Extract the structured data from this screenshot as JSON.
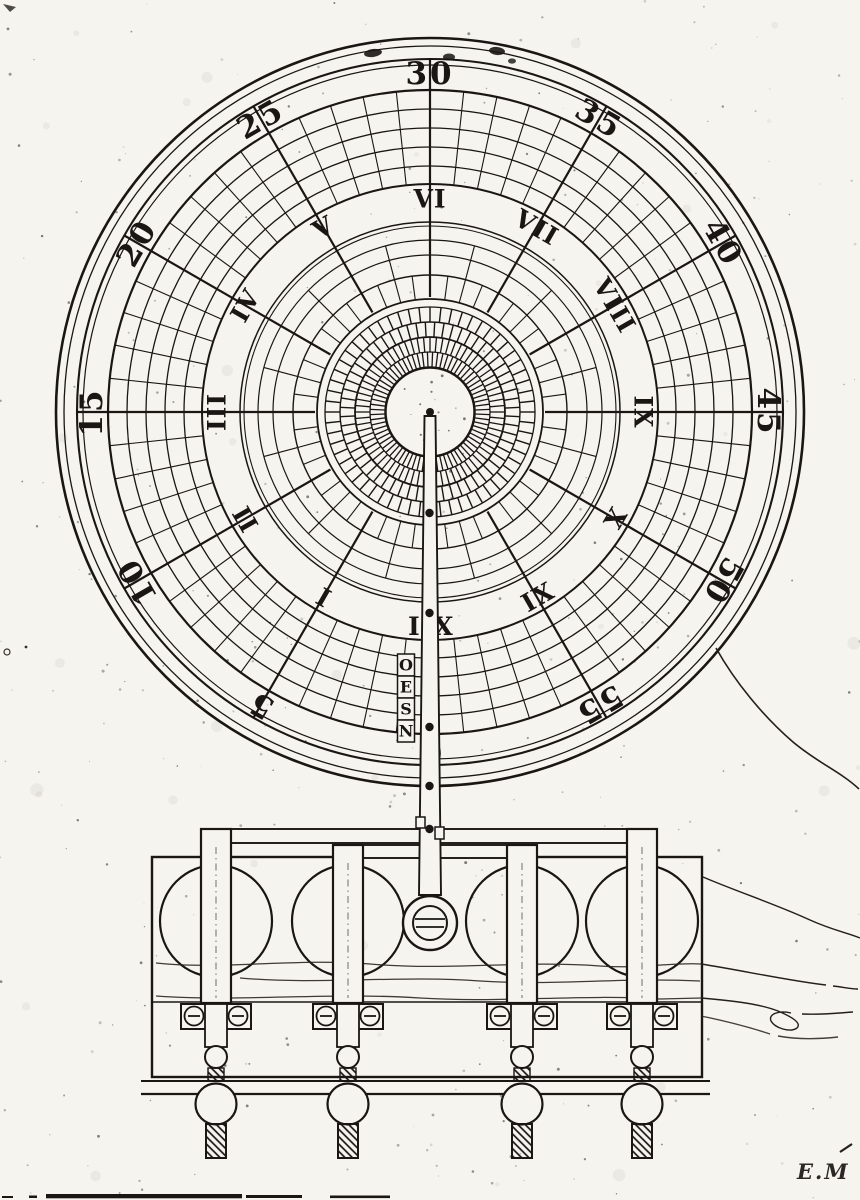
{
  "page": {
    "background": "#f5f4ef",
    "ink": "#191613",
    "signature": "E.M"
  },
  "dial": {
    "minute_labels": [
      {
        "text": "0",
        "angle": 180
      },
      {
        "text": "5",
        "angle": 210
      },
      {
        "text": "10",
        "angle": 240
      },
      {
        "text": "15",
        "angle": 270
      },
      {
        "text": "20",
        "angle": 300
      },
      {
        "text": "25",
        "angle": 330
      },
      {
        "text": "30",
        "angle": 0
      },
      {
        "text": "35",
        "angle": 30
      },
      {
        "text": "40",
        "angle": 60
      },
      {
        "text": "45",
        "angle": 90
      },
      {
        "text": "50",
        "angle": 120
      },
      {
        "text": "55",
        "angle": 150
      }
    ],
    "hour_labels": [
      {
        "text": "VI",
        "angle": 0
      },
      {
        "text": "VII",
        "angle": 30
      },
      {
        "text": "VIII",
        "angle": 60
      },
      {
        "text": "IX",
        "angle": 90
      },
      {
        "text": "X",
        "angle": 120
      },
      {
        "text": "XI",
        "angle": 150
      },
      {
        "text": "XII",
        "angle": 180
      },
      {
        "text": "I",
        "angle": 210
      },
      {
        "text": "II",
        "angle": 240
      },
      {
        "text": "III",
        "angle": 270
      },
      {
        "text": "IV",
        "angle": 300
      },
      {
        "text": "V",
        "angle": 330
      }
    ]
  },
  "pointer": {
    "letters": [
      "O",
      "E",
      "S",
      "N"
    ]
  }
}
